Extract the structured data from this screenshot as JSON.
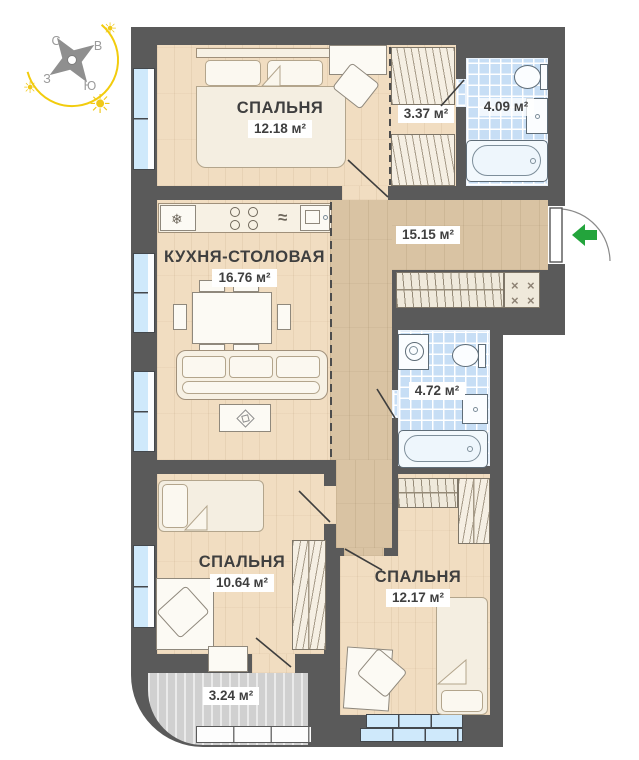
{
  "compass": {
    "north": "С",
    "east": "В",
    "west": "З",
    "south": "Ю"
  },
  "rooms": {
    "bedroom_top": {
      "name": "СПАЛЬНЯ",
      "area": "12.18 м²"
    },
    "closet": {
      "area": "3.37 м²"
    },
    "bathroom_top": {
      "area": "4.09 м²"
    },
    "hallway": {
      "area": "15.15 м²"
    },
    "kitchen": {
      "name": "КУХНЯ-СТОЛОВАЯ",
      "area": "16.76 м²"
    },
    "bathroom_mid": {
      "area": "4.72 м²"
    },
    "bedroom_left": {
      "name": "СПАЛЬНЯ",
      "area": "10.64 м²"
    },
    "bedroom_right": {
      "name": "СПАЛЬНЯ",
      "area": "12.17 м²"
    },
    "balcony": {
      "area": "3.24 м²"
    }
  },
  "icons": {
    "snowflake": "❄",
    "waves": "≈",
    "sun": "☀",
    "x_mark": "×"
  },
  "colors": {
    "wall": "#5a5a5a",
    "wood_light": "#f1ddc1",
    "wood_dark": "#d9c3a3",
    "tile_blue": "#c7def5",
    "window_blue": "#cfe9fb",
    "balcony_gray": "#dcdcdc",
    "entry_arrow_green": "#23a43c",
    "compass_yellow": "#f2cc0d",
    "label_text": "#3f3f3f"
  }
}
